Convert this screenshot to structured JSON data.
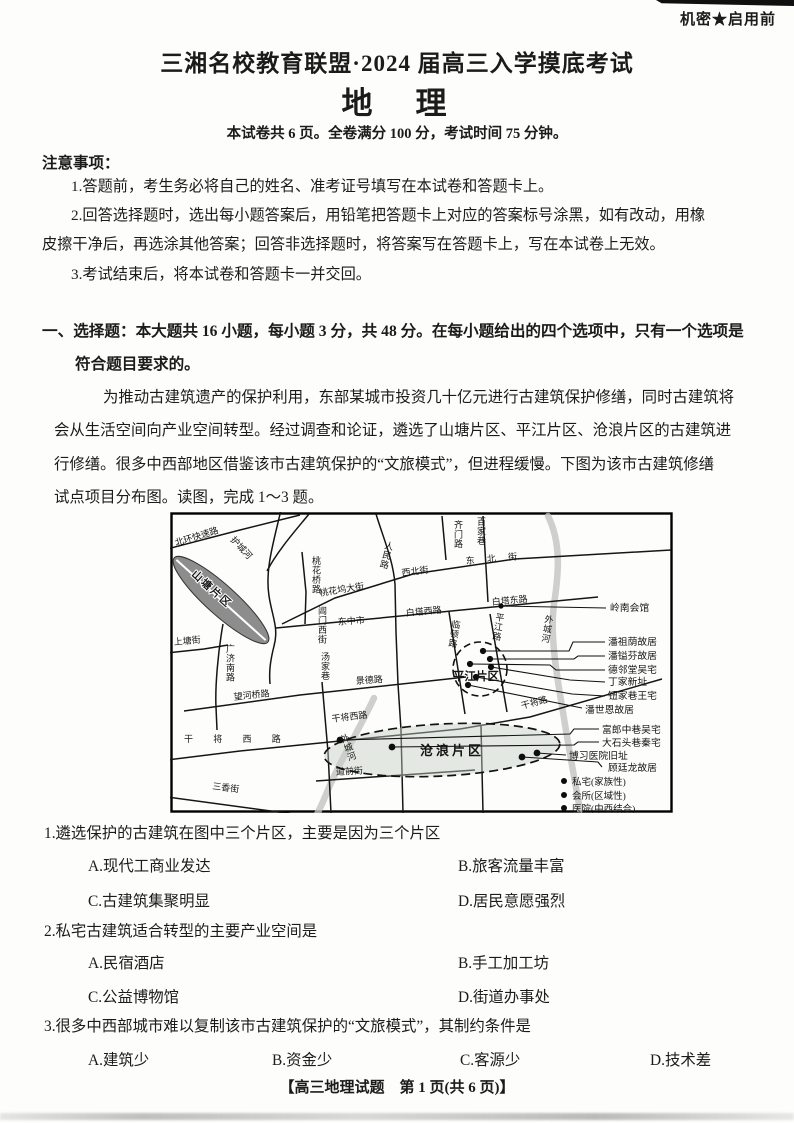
{
  "header": {
    "security": "机密★启用前",
    "title": "三湘名校教育联盟·2024 届高三入学摸底考试",
    "subject": "地　理",
    "exam_info": "本试卷共 6 页。全卷满分 100 分，考试时间 75 分钟。"
  },
  "notice": {
    "heading": "注意事项：",
    "lines": [
      "1.答题前，考生务必将自己的姓名、准考证号填写在本试卷和答题卡上。",
      "2.回答选择题时，选出每小题答案后，用铅笔把答题卡上对应的答案标号涂黑，如有改动，用橡",
      "皮擦干净后，再选涂其他答案；回答非选择题时，将答案写在答题卡上，写在本试卷上无效。",
      "3.考试结束后，将本试卷和答题卡一并交回。"
    ]
  },
  "section": {
    "line1": "一、选择题：本大题共 16 小题，每小题 3 分，共 48 分。在每小题给出的四个选项中，只有一个选项是",
    "line2": "符合题目要求的。"
  },
  "passage": {
    "lines": [
      "为推动古建筑遗产的保护利用，东部某城市投资几十亿元进行古建筑保护修缮，同时古建筑将",
      "会从生活空间向产业空间转型。经过调查和论证，遴选了山塘片区、平江片区、沧浪片区的古建筑进",
      "行修缮。很多中西部地区借鉴该市古建筑保护的“文旅模式”，但进程缓慢。下图为该市古建筑修缮",
      "试点项目分布图。读图，完成 1～3 题。"
    ]
  },
  "map": {
    "districts": {
      "shantang": "山塘片区",
      "pingjiang": "平江片区",
      "canglang": "沧浪片区"
    },
    "roads": {
      "beihuan": "北环快速路",
      "hucheng": "护城河",
      "shangtang": "上塘街",
      "guangji": "广济南路",
      "taohuaqiao": "桃花桥路",
      "taohuawu": "桃花坞大街",
      "xibei": "西北街",
      "dongbei": "东 北 街",
      "renmin": "人民路",
      "qimen": "齐门路",
      "baijiaxiang": "百家巷",
      "dongzhongshi": "东中市",
      "baitaxi": "白塔西路",
      "baitadong": "白塔东路",
      "changmenxijie": "阊门西街",
      "tangjiaxiang": "汤家巷",
      "lindun": "临顿路",
      "pingjianglu": "平江路",
      "wangheqiaolu": "望河桥路",
      "jingdelu": "景德路",
      "ganjiangxilu_spread": "干 将 西 路",
      "ganjiangxilu": "干将西路",
      "ganjianglu": "干将路",
      "daoqianjie": "道前街",
      "sanxiangjie": "三香街"
    },
    "rivers": {
      "waichenghe_right": "外城河",
      "waichenghe_mid": "外城河"
    },
    "sites": {
      "lingnan": "岭南会馆",
      "panzuyin": "潘祖荫故居",
      "panyifen": "潘镒芬故居",
      "delintang": "德邻堂吴宅",
      "dingjiaxinzhi": "丁家新址",
      "niujiaxiang": "钮家巷王宅",
      "panshien": "潘世恩故居",
      "fulangzhong": "富郎中巷吴宅",
      "dashitou": "大石头巷秦宅",
      "boxi": "博习医院旧址",
      "gutinglong": "顾廷龙故居"
    },
    "legend": {
      "private": "私宅(家族性)",
      "club": "会所(区域性)",
      "hospital": "医院(中西结合)"
    }
  },
  "questions": [
    {
      "stem": "1.遴选保护的古建筑在图中三个片区，主要是因为三个片区",
      "options": [
        "A.现代工商业发达",
        "B.旅客流量丰富",
        "C.古建筑集聚明显",
        "D.居民意愿强烈"
      ]
    },
    {
      "stem": "2.私宅古建筑适合转型的主要产业空间是",
      "options": [
        "A.民宿酒店",
        "B.手工加工坊",
        "C.公益博物馆",
        "D.街道办事处"
      ]
    },
    {
      "stem": "3.很多中西部城市难以复制该市古建筑保护的“文旅模式”，其制约条件是",
      "options": [
        "A.建筑少",
        "B.资金少",
        "C.客源少",
        "D.技术差"
      ]
    }
  ],
  "footer": "【高三地理试题　第 1 页(共 6 页)】"
}
